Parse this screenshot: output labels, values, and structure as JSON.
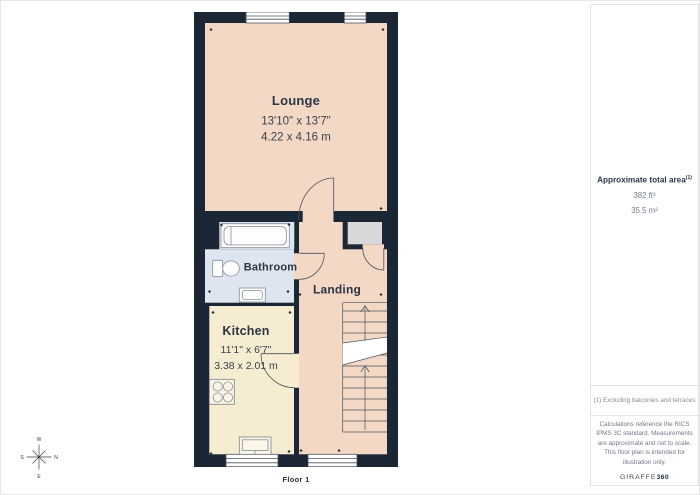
{
  "floorplan": {
    "floor_label": "Floor 1",
    "rooms": [
      {
        "name": "Lounge",
        "dims_imperial": "13'10\" x 13'7\"",
        "dims_metric": "4.22 x 4.16 m"
      },
      {
        "name": "Bathroom",
        "dims_imperial": "",
        "dims_metric": ""
      },
      {
        "name": "Landing",
        "dims_imperial": "",
        "dims_metric": ""
      },
      {
        "name": "Kitchen",
        "dims_imperial": "11'1\" x 6'7\"",
        "dims_metric": "3.38 x 2.01 m"
      }
    ],
    "compass": {
      "n": "N",
      "s": "S",
      "e": "E",
      "w": "W"
    }
  },
  "sidebar": {
    "area_title": "Approximate total area",
    "area_superscript": "(1)",
    "area_ft": "382 ft²",
    "area_m": "35.5 m²",
    "footnote": "(1) Excluding balconies and terraces",
    "disclaimer": "Calculations reference the RICS IPMS 3C standard. Measurements are approximate and not to scale. This floor plan is intended for illustration only.",
    "brand_name": "GIRAFFE",
    "brand_number": "360"
  },
  "colors": {
    "wall": "#1b2734",
    "lounge_landing_floor": "#f3d8c6",
    "kitchen_floor": "#f6ecd2",
    "bathroom_floor": "#dfe5f0",
    "closet_floor": "#d8d8d8"
  }
}
